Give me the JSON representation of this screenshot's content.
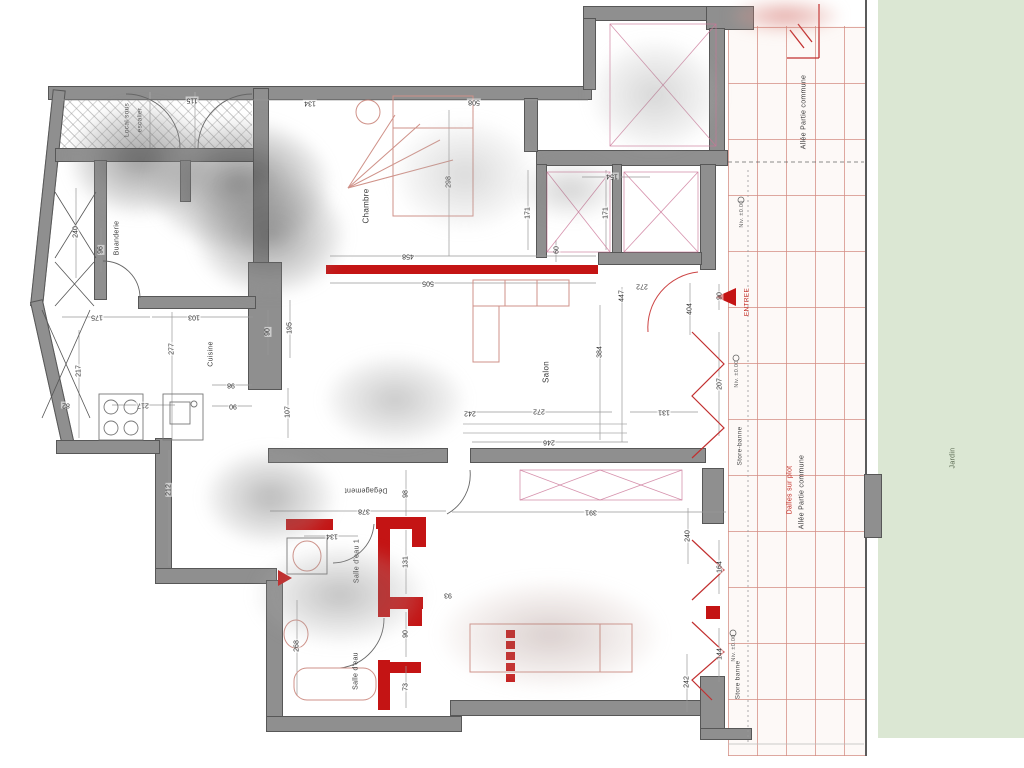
{
  "plan_title": "Plan d'appartement (rez-de-jardin)",
  "colors": {
    "wall_gray": "#8f8f8f",
    "new_wall_red": "#c41414",
    "furniture_red": "#cf9188",
    "tile_joint_pink": "#d48c82",
    "garden_green": "#dbe7d3",
    "dimension_text": "#333333"
  },
  "labels": [
    {
      "t": "Local sous",
      "x": 127,
      "y": 120,
      "r": -90,
      "c": "tiny"
    },
    {
      "t": "escalier",
      "x": 140,
      "y": 120,
      "r": -90,
      "c": "tiny"
    },
    {
      "t": "Buanderie",
      "x": 117,
      "y": 238,
      "r": -90,
      "c": "small"
    },
    {
      "t": "Chambre",
      "x": 366,
      "y": 206,
      "r": -90
    },
    {
      "t": "Cuisine",
      "x": 211,
      "y": 354,
      "r": -90,
      "c": "small"
    },
    {
      "t": "Salon",
      "x": 546,
      "y": 372,
      "r": -90
    },
    {
      "t": "Dégagement",
      "x": 366,
      "y": 490,
      "r": 180,
      "c": "small"
    },
    {
      "t": "Salle d'eau 1",
      "x": 357,
      "y": 561,
      "r": -90,
      "c": "small"
    },
    {
      "t": "Salle d'eau",
      "x": 356,
      "y": 671,
      "r": -90,
      "c": "small"
    },
    {
      "t": "Store-banne",
      "x": 740,
      "y": 446,
      "r": -90,
      "c": "tiny"
    },
    {
      "t": "Store banne",
      "x": 738,
      "y": 680,
      "r": -90,
      "c": "tiny"
    },
    {
      "t": "Allée Partie commune",
      "x": 804,
      "y": 112,
      "r": -90,
      "c": "small"
    },
    {
      "t": "Allée Partie commune",
      "x": 802,
      "y": 492,
      "r": -90,
      "c": "small"
    },
    {
      "t": "Dalles sur plot",
      "x": 790,
      "y": 490,
      "r": -90,
      "c": "small red"
    },
    {
      "t": "Jardin",
      "x": 953,
      "y": 458,
      "r": -90,
      "c": "small green"
    },
    {
      "t": "ENTREE",
      "x": 747,
      "y": 302,
      "r": -90,
      "c": "tiny red"
    },
    {
      "t": "Niv. ±0.00",
      "x": 742,
      "y": 214,
      "r": -90,
      "c": "micro"
    },
    {
      "t": "Niv. ±0.00",
      "x": 737,
      "y": 374,
      "r": -90,
      "c": "micro"
    },
    {
      "t": "Niv. ±0.00",
      "x": 734,
      "y": 648,
      "r": -90,
      "c": "micro"
    }
  ],
  "dimensions": [
    {
      "t": "115",
      "x": 192,
      "y": 100,
      "r": 180
    },
    {
      "t": "134",
      "x": 310,
      "y": 103,
      "r": 180
    },
    {
      "t": "508",
      "x": 474,
      "y": 102,
      "r": 180
    },
    {
      "t": "154",
      "x": 612,
      "y": 176,
      "r": 180
    },
    {
      "t": "298",
      "x": 449,
      "y": 182,
      "r": -90
    },
    {
      "t": "171",
      "x": 528,
      "y": 213,
      "r": -90
    },
    {
      "t": "171",
      "x": 606,
      "y": 213,
      "r": -90
    },
    {
      "t": "60",
      "x": 557,
      "y": 250,
      "r": -90
    },
    {
      "t": "458",
      "x": 408,
      "y": 256,
      "r": 180
    },
    {
      "t": "505",
      "x": 428,
      "y": 283,
      "r": 180
    },
    {
      "t": "240",
      "x": 76,
      "y": 232,
      "r": -90
    },
    {
      "t": "96",
      "x": 101,
      "y": 250,
      "r": -90
    },
    {
      "t": "175",
      "x": 97,
      "y": 317,
      "r": 180
    },
    {
      "t": "103",
      "x": 194,
      "y": 317,
      "r": 180
    },
    {
      "t": "277",
      "x": 172,
      "y": 349,
      "r": -90
    },
    {
      "t": "217",
      "x": 79,
      "y": 371,
      "r": -90
    },
    {
      "t": "195",
      "x": 290,
      "y": 328,
      "r": -90
    },
    {
      "t": "90",
      "x": 268,
      "y": 332,
      "r": -90
    },
    {
      "t": "98",
      "x": 231,
      "y": 385,
      "r": 180
    },
    {
      "t": "90",
      "x": 233,
      "y": 406,
      "r": 180
    },
    {
      "t": "217",
      "x": 143,
      "y": 405,
      "r": 180
    },
    {
      "t": "82",
      "x": 66,
      "y": 405,
      "r": 180
    },
    {
      "t": "107",
      "x": 288,
      "y": 412,
      "r": -90
    },
    {
      "t": "212",
      "x": 169,
      "y": 490,
      "r": -90
    },
    {
      "t": "447",
      "x": 622,
      "y": 296,
      "r": -90
    },
    {
      "t": "272",
      "x": 642,
      "y": 286,
      "r": 180
    },
    {
      "t": "404",
      "x": 690,
      "y": 309,
      "r": -90
    },
    {
      "t": "90",
      "x": 720,
      "y": 296,
      "r": -90
    },
    {
      "t": "384",
      "x": 600,
      "y": 352,
      "r": -90
    },
    {
      "t": "207",
      "x": 720,
      "y": 384,
      "r": -90
    },
    {
      "t": "272",
      "x": 539,
      "y": 411,
      "r": 180
    },
    {
      "t": "131",
      "x": 664,
      "y": 412,
      "r": 180
    },
    {
      "t": "242",
      "x": 470,
      "y": 413,
      "r": 180
    },
    {
      "t": "246",
      "x": 549,
      "y": 442,
      "r": 180
    },
    {
      "t": "98",
      "x": 406,
      "y": 494,
      "r": -90
    },
    {
      "t": "378",
      "x": 364,
      "y": 511,
      "r": 180
    },
    {
      "t": "391",
      "x": 591,
      "y": 512,
      "r": 180
    },
    {
      "t": "93",
      "x": 448,
      "y": 595,
      "r": 180
    },
    {
      "t": "134",
      "x": 332,
      "y": 536,
      "r": 180
    },
    {
      "t": "131",
      "x": 406,
      "y": 562,
      "r": -90
    },
    {
      "t": "268",
      "x": 297,
      "y": 646,
      "r": -90
    },
    {
      "t": "90",
      "x": 406,
      "y": 634,
      "r": -90
    },
    {
      "t": "73",
      "x": 406,
      "y": 687,
      "r": -90
    },
    {
      "t": "240",
      "x": 688,
      "y": 536,
      "r": -90
    },
    {
      "t": "164",
      "x": 720,
      "y": 567,
      "r": -90
    },
    {
      "t": "144",
      "x": 720,
      "y": 654,
      "r": -90
    },
    {
      "t": "242",
      "x": 687,
      "y": 682,
      "r": -90
    }
  ]
}
